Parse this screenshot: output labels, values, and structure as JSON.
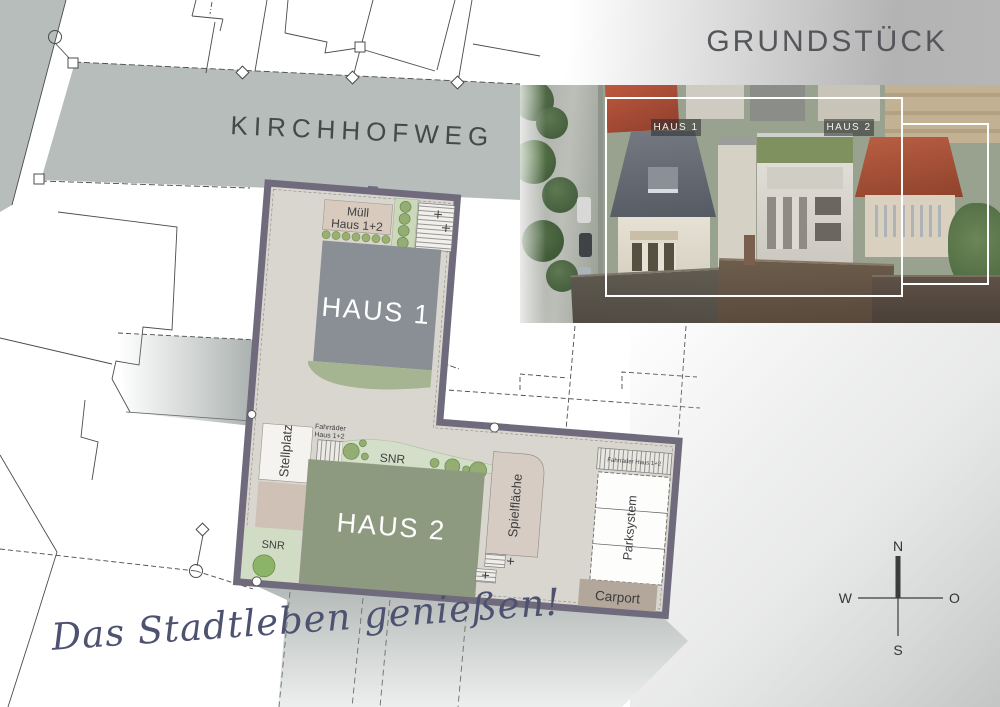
{
  "header": {
    "title": "GRUNDSTÜCK"
  },
  "map": {
    "street_name": "KIRCHHOFWEG",
    "tagline": "Das Stadtleben genießen!"
  },
  "plan": {
    "muell_line1": "Müll",
    "muell_line2": "Haus 1+2",
    "haus1": "HAUS 1",
    "haus2": "HAUS 2",
    "stellplatz": "Stellplatz",
    "fahrraeder_line1": "Fahrräder",
    "fahrraeder_line2": "Haus 1+2",
    "snr_mid": "SNR",
    "snr_bottom": "SNR",
    "spielflaeche": "Spielfläche",
    "parksystem": "Parksystem",
    "carport": "Carport",
    "fahrraeder_right": "Fahrräder Haus 1+2"
  },
  "photo": {
    "haus1_tag": "HAUS 1",
    "haus2_tag": "HAUS 2"
  },
  "compass": {
    "n": "N",
    "o": "O",
    "s": "S",
    "w": "W"
  },
  "colors": {
    "plot_border": "#6f6b7d",
    "plot_base": "#d9d6d0",
    "haus1_fill": "#8a8e95",
    "haus2_fill": "#8e9a80",
    "green_area": "#cfdcc3",
    "street_fill": "#b7bdbb",
    "carport_fill": "#b3a79b",
    "tagline_ink": "#4d5270"
  }
}
